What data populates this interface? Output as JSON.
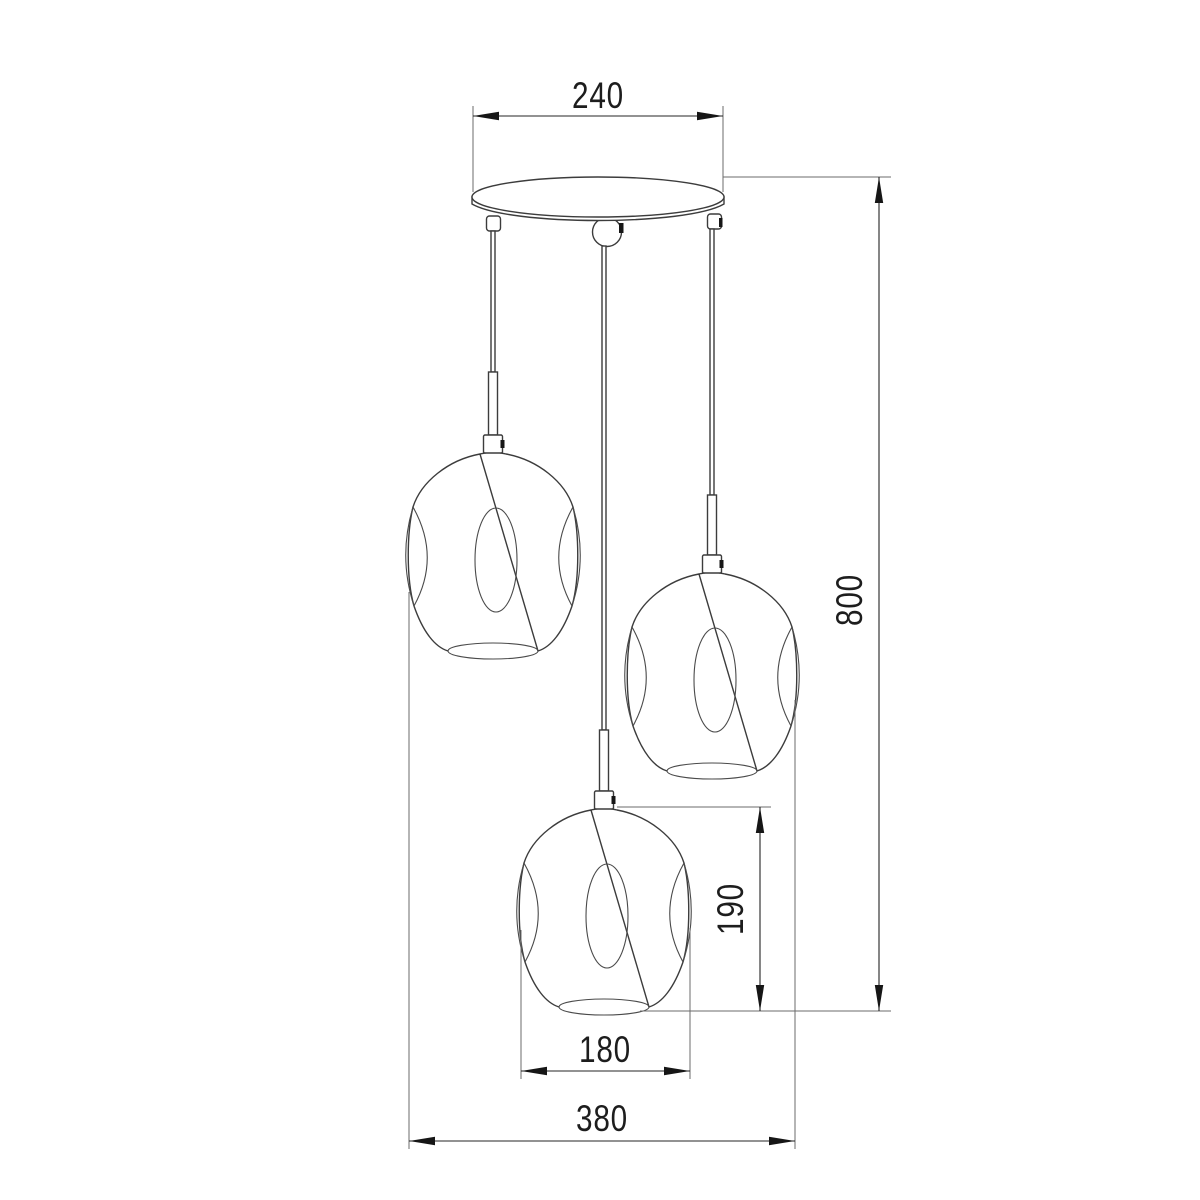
{
  "page": {
    "background": "#ffffff",
    "ink": "#1d1d1d",
    "fixture_line_color": "#3c3c3c",
    "extension_line_color": "#6b6b6b"
  },
  "drawing": {
    "subject": "cascade-pendant-lamp-technical-drawing",
    "parts": [
      "ceiling-canopy",
      "cord-cap-left",
      "swivel-ball",
      "cord-cap-right",
      "suspension-cord-left",
      "suspension-cord-center",
      "suspension-cord-right",
      "glass-shade-left",
      "glass-shade-right",
      "glass-shade-bottom"
    ],
    "dimensions": {
      "canopy_diameter": {
        "label": "240",
        "orientation": "horizontal",
        "measures": "ceiling canopy diameter"
      },
      "overall_height": {
        "label": "800",
        "orientation": "vertical",
        "measures": "overall drop height"
      },
      "shade_height": {
        "label": "190",
        "orientation": "vertical",
        "measures": "glass shade height"
      },
      "shade_diameter": {
        "label": "180",
        "orientation": "horizontal",
        "measures": "glass shade diameter"
      },
      "overall_width": {
        "label": "380",
        "orientation": "horizontal",
        "measures": "overall fixture width"
      }
    }
  }
}
